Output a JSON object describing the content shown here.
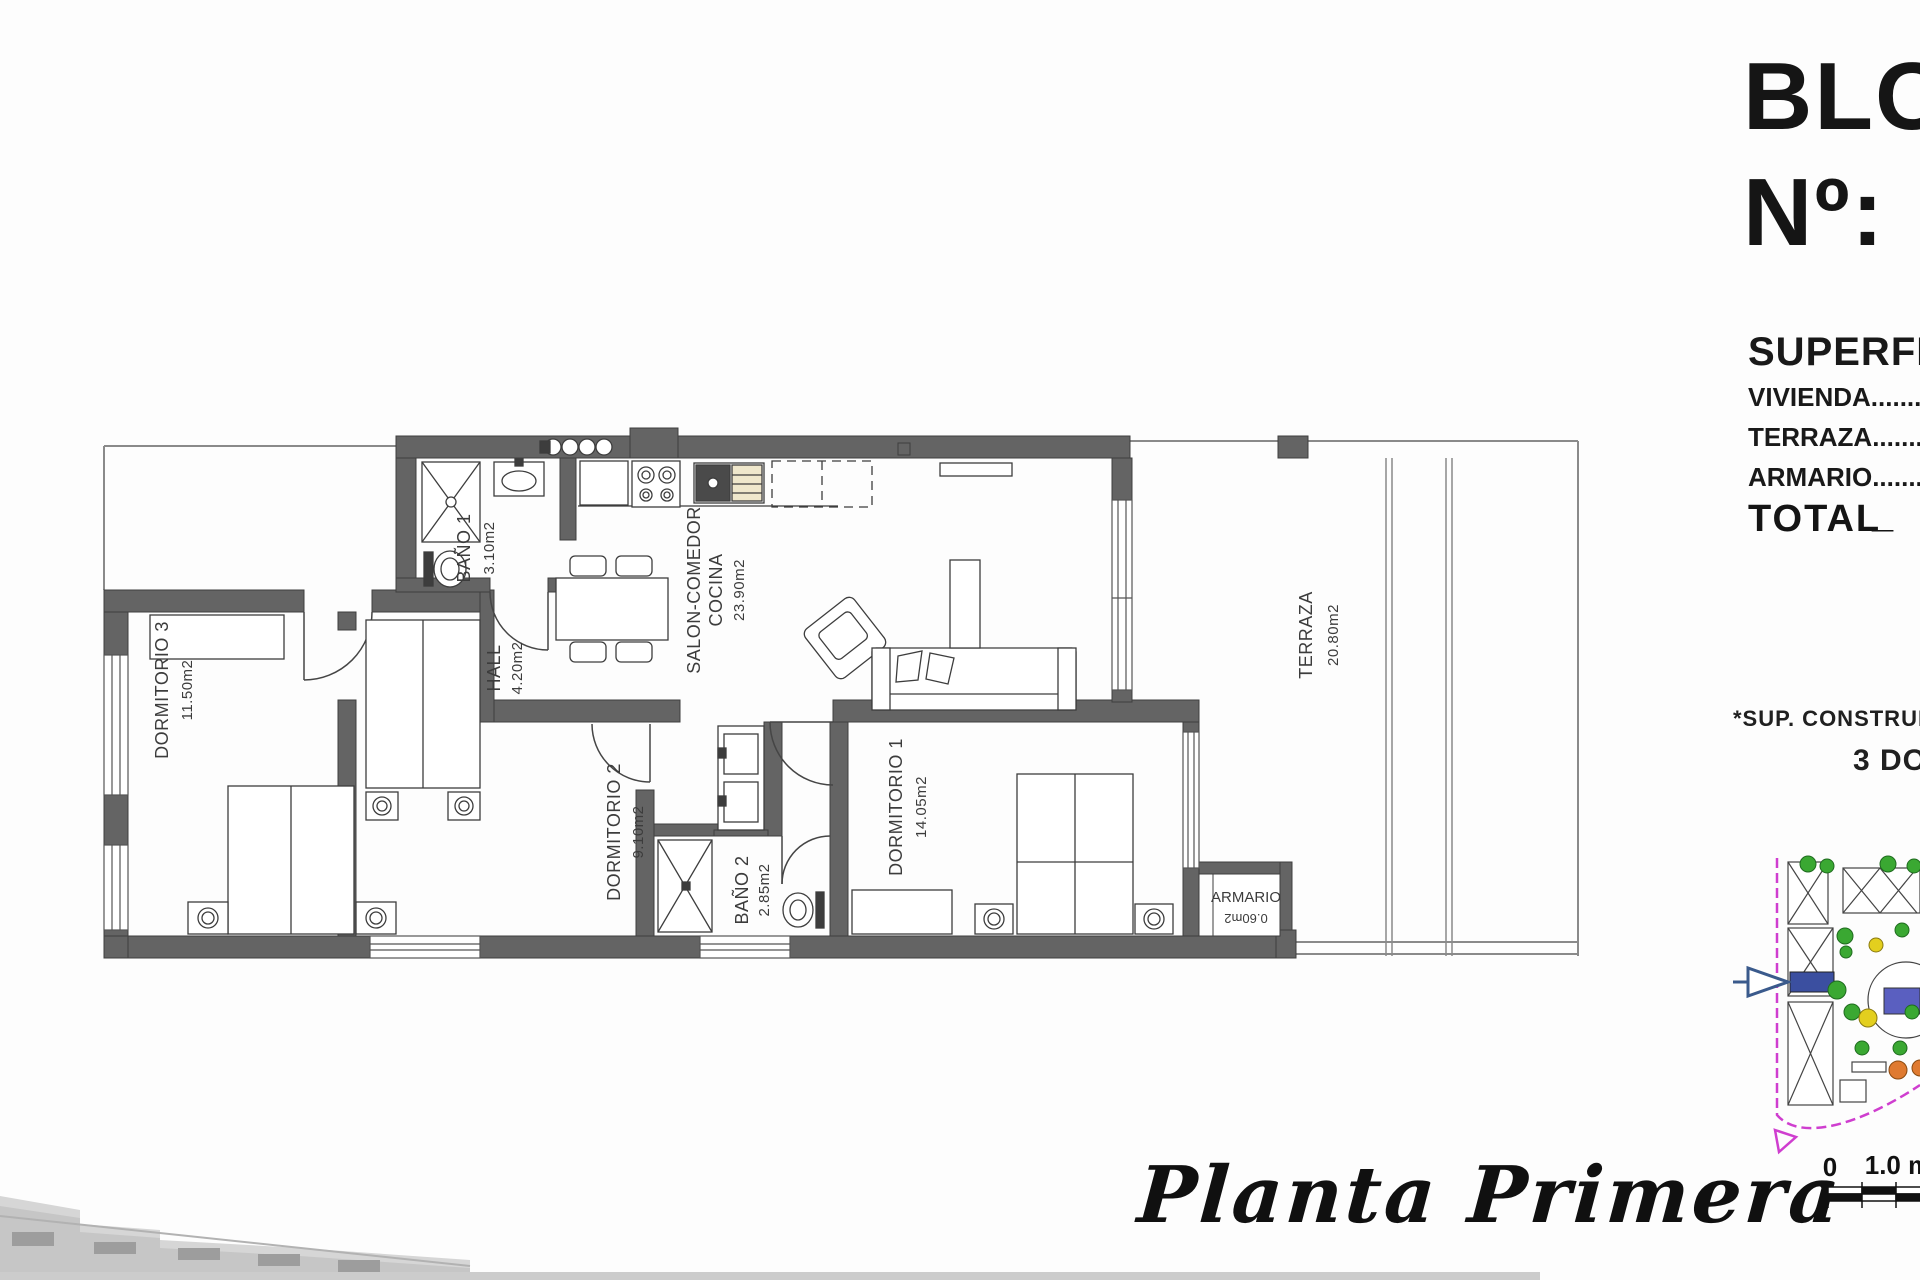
{
  "panel": {
    "block_title": "BLOQUE",
    "block_number_label": "Nº:",
    "surfaces_title": "SUPERFICIES",
    "surface_rows": {
      "vivienda": "VIVIENDA..........................",
      "terraza": "TERRAZA..........................",
      "armario": "ARMARIO.........................."
    },
    "total_label": "TOTAL",
    "total_placeholder": "_",
    "note_construida": "*SUP. CONSTRUIDA CON",
    "note_dormitorios": "3 DORMITORIOS"
  },
  "rooms": {
    "dormitorio3": {
      "name": "DORMITORIO 3",
      "area": "11.50m2"
    },
    "bano1": {
      "name": "BAÑO 1",
      "area": "3.10m2"
    },
    "hall": {
      "name": "HALL",
      "area": "4.20m2"
    },
    "salon": {
      "name_line1": "SALON-COMEDOR",
      "name_line2": "COCINA",
      "area": "23.90m2"
    },
    "terraza": {
      "name": "TERRAZA",
      "area": "20.80m2"
    },
    "dormitorio2": {
      "name": "DORMITORIO 2",
      "area": "9.10m2"
    },
    "bano2": {
      "name": "BAÑO 2",
      "area": "2.85m2"
    },
    "dormitorio1": {
      "name": "DORMITORIO 1",
      "area": "14.05m2"
    },
    "armario": {
      "name": "ARMARIO",
      "area": "0.60m2"
    }
  },
  "footer": {
    "plan_title": "Planta Primera"
  },
  "sitemap": {
    "scale_zero": "0",
    "scale_one": "1.0 m"
  },
  "colors": {
    "wall": "#646464",
    "line": "#3d3d3d",
    "accent_blue": "#3b4fa0",
    "pool_blue": "#5a5fc0",
    "tree_green": "#3aa832",
    "tree_yellow": "#e3cf1e",
    "tree_orange": "#df7a30",
    "boundary_magenta": "#cf3ecf"
  }
}
